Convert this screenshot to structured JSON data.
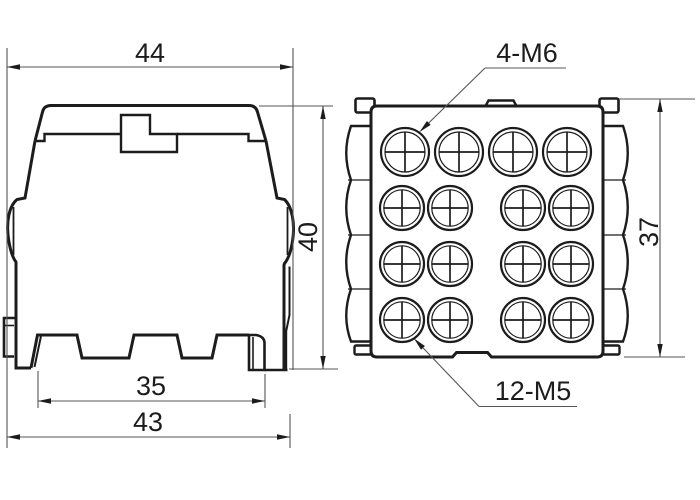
{
  "page": {
    "background": "#ffffff",
    "line_color": "#1c1c1c",
    "dim_line_color": "#555555",
    "description": "Technical drawing of a DIN-rail terminal distribution block, side view and front view"
  },
  "views": {
    "side_view": {
      "dimensions": {
        "top_width": "44",
        "height": "40",
        "din_rail_slot": "35",
        "bottom_width": "43"
      }
    },
    "front_view": {
      "dimensions": {
        "height": "37"
      },
      "callouts": {
        "m6_screws": "4-M6",
        "m5_screws": "12-M5"
      },
      "screw_grid": {
        "rows": 4,
        "columns": 4,
        "m6_count": 4,
        "m5_count": 12
      }
    }
  }
}
